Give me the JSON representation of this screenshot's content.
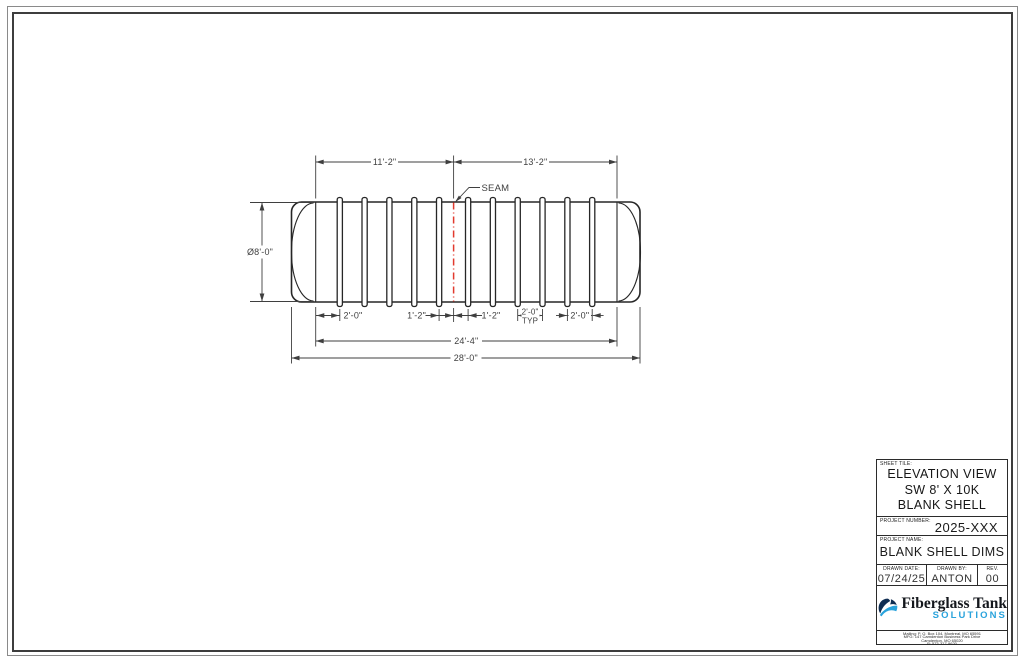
{
  "drawing": {
    "dims": {
      "top_left_length": "11'-2\"",
      "top_right_length": "13'-2\"",
      "seam_label": "SEAM",
      "diameter": "Ø8'-0\"",
      "end_rib_left": "2'-0\"",
      "seam_offset_left": "1'-2\"",
      "seam_offset_right": "1'-2\"",
      "rib_spacing": "2'-0\"",
      "rib_spacing_suffix": "TYP",
      "end_rib_right": "2'-0\"",
      "shell_straight_length": "24'-4\"",
      "overall_length": "28'-0\""
    },
    "colors": {
      "seam_red": "#e23a2e",
      "tank_line": "#262626",
      "dim_line": "#3f3f3f"
    }
  },
  "title_block": {
    "sheet_title": {
      "label": "SHEET TILE:",
      "lines": [
        "ELEVATION VIEW",
        "SW 8' X 10K",
        "BLANK SHELL"
      ]
    },
    "project_number": {
      "label": "PROJECT NUMBER:",
      "value": "2025-XXX"
    },
    "project_name": {
      "label": "PROJECT NAME:",
      "value": "BLANK SHELL DIMS"
    },
    "drawn_date": {
      "label": "DRAWN DATE:",
      "value": "07/24/25"
    },
    "drawn_by": {
      "label": "DRAWN BY:",
      "value": "ANTON"
    },
    "rev": {
      "label": "REV.",
      "value": "00"
    },
    "logo": {
      "name": "Fiberglass Tank",
      "sub": "SOLUTIONS",
      "accent_blue": "#2aa3dc",
      "dark_navy": "#0f2d52"
    },
    "address_lines": [
      "Mailing: P. O. Box 104, Montreal, MO 65591",
      "MFG: 147 Camdenton Business Park Drive",
      "Camdenton, MO 65020",
      "P: 573-317-9620"
    ]
  }
}
